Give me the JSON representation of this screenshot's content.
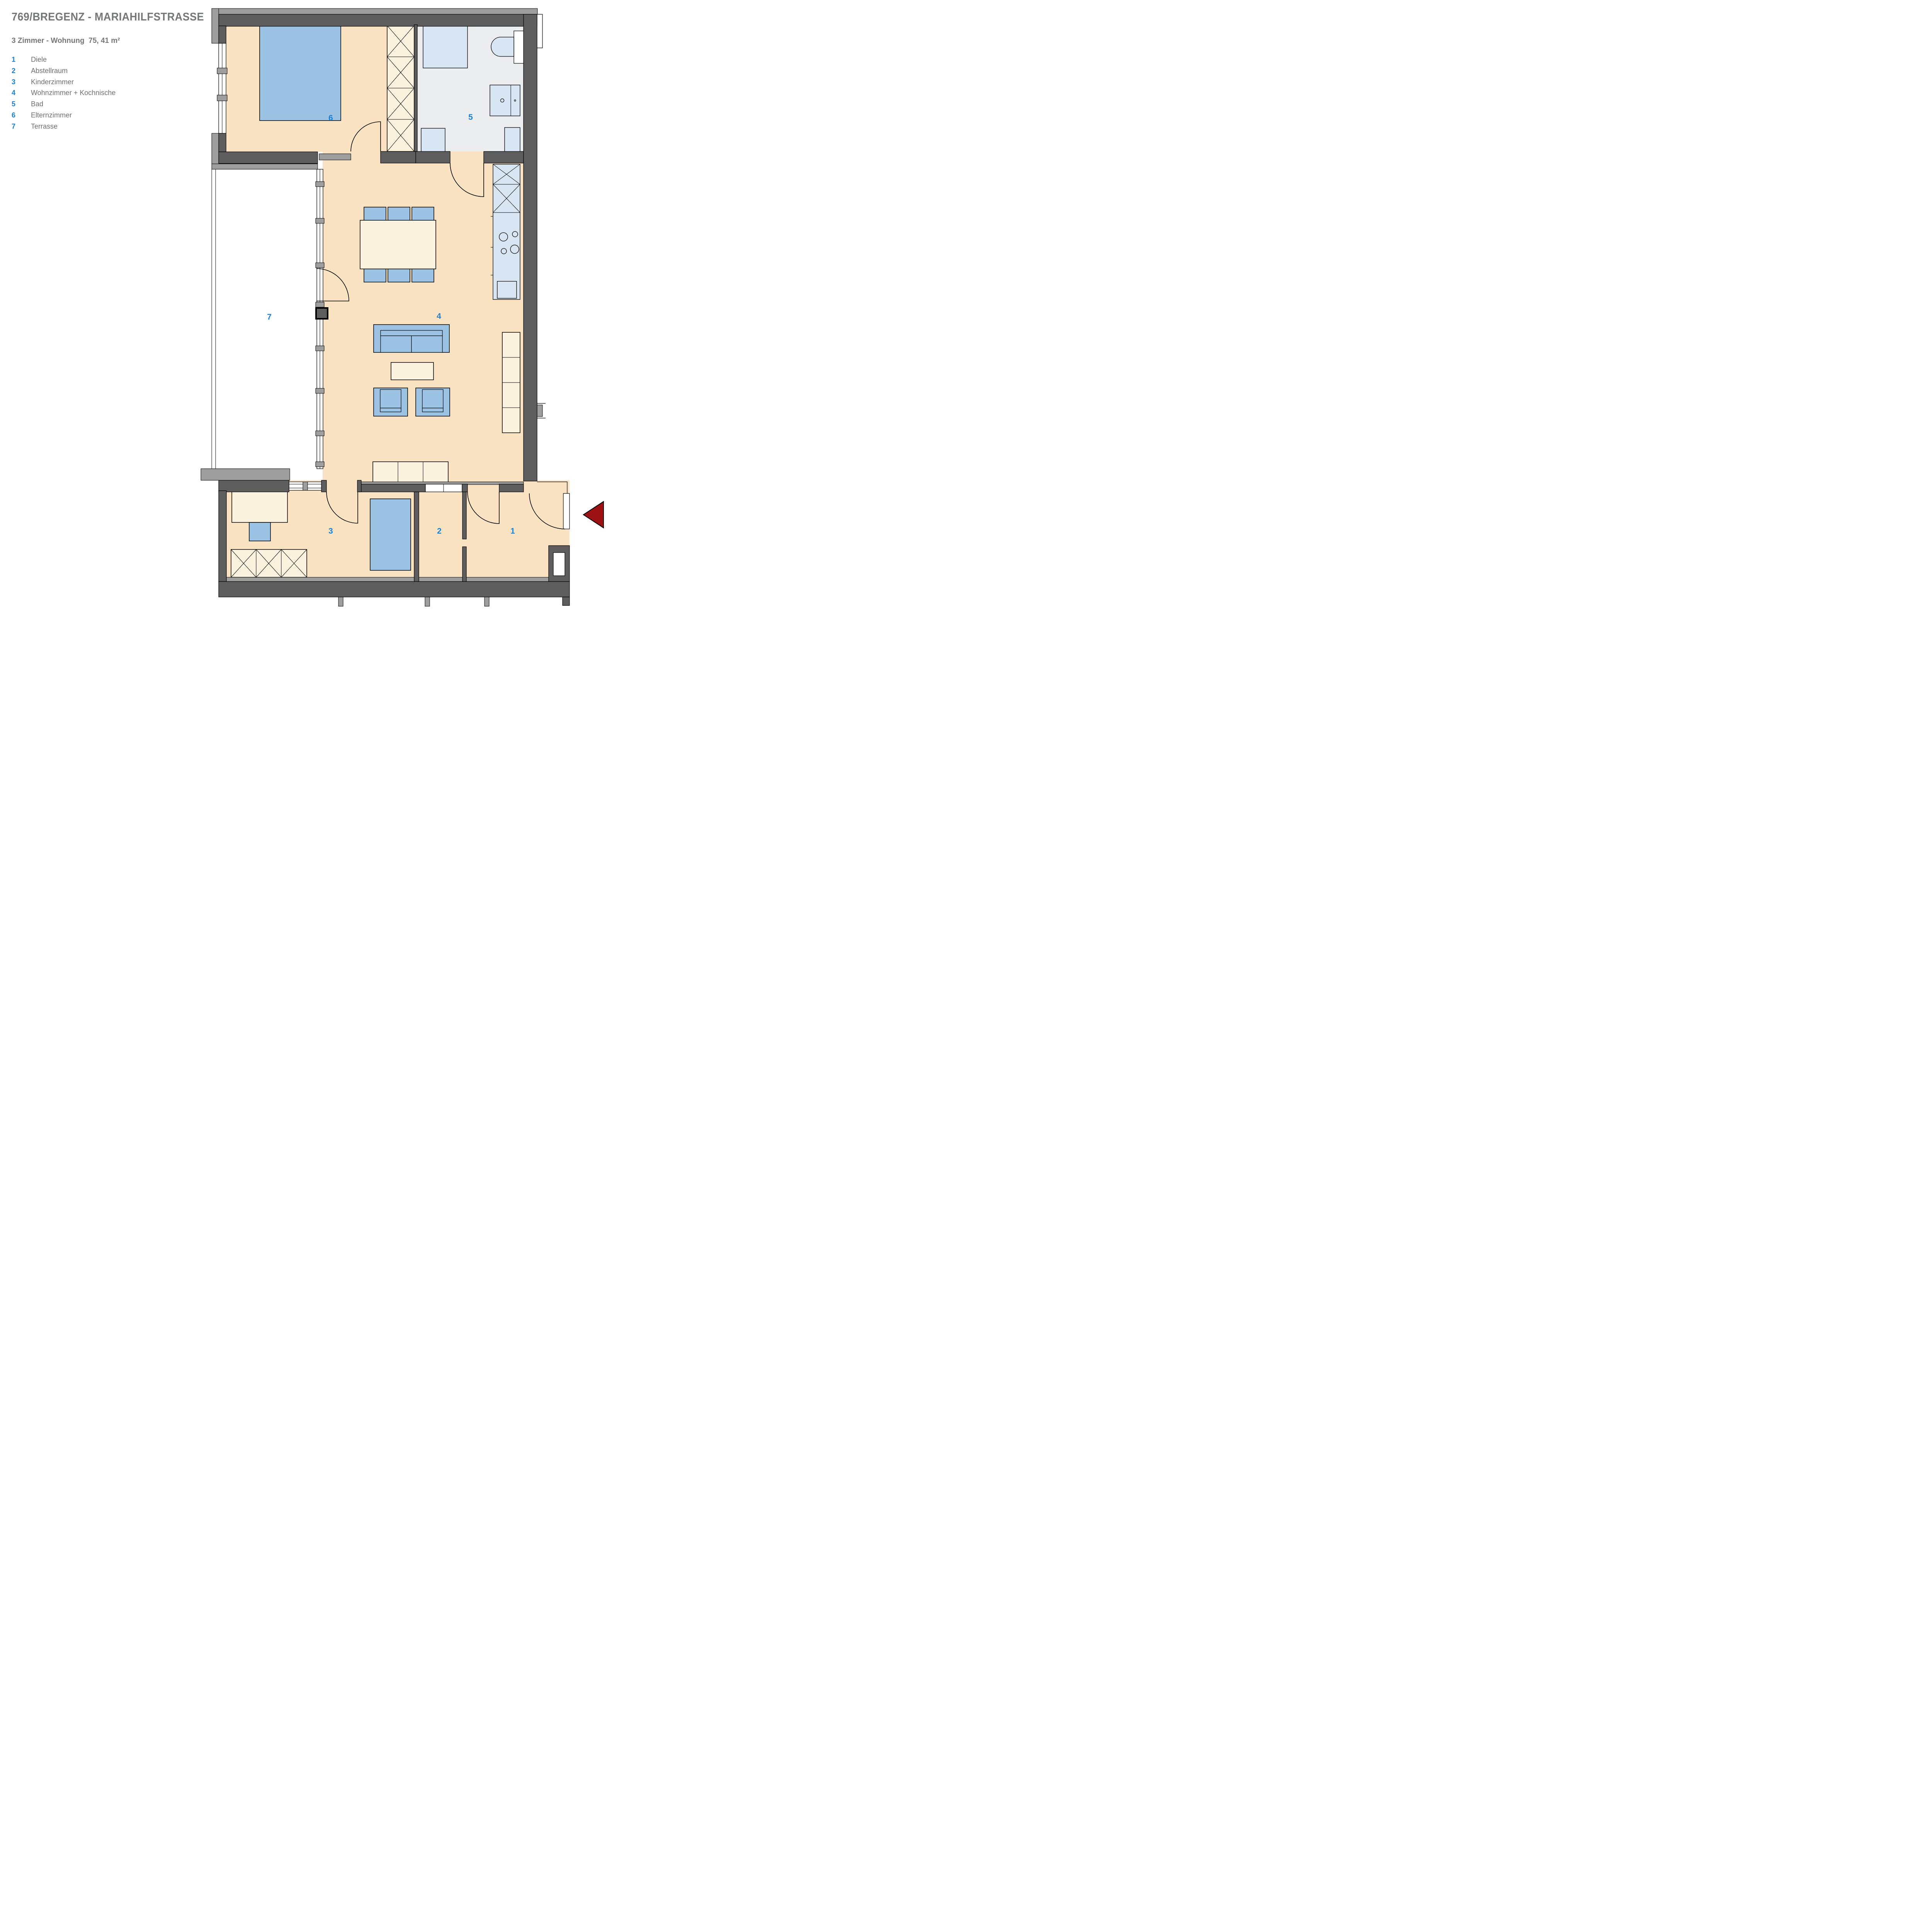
{
  "header": {
    "title": "769/BREGENZ - MARIAHILFSTRASSE",
    "subtitle": "3 Zimmer - Wohnung  75, 41 m²"
  },
  "legend": {
    "items": [
      {
        "number": "1",
        "label": "Diele"
      },
      {
        "number": "2",
        "label": "Abstellraum"
      },
      {
        "number": "3",
        "label": "Kinderzimmer"
      },
      {
        "number": "4",
        "label": "Wohnzimmer + Kochnische"
      },
      {
        "number": "5",
        "label": "Bad"
      },
      {
        "number": "6",
        "label": "Elternzimmer"
      },
      {
        "number": "7",
        "label": "Terrasse"
      }
    ]
  },
  "plan": {
    "type": "apartment-floor-plan",
    "rooms_total": 7,
    "entrance": {
      "symbol": "red-arrow-left",
      "location": "right wall of room 1 (Diele)"
    }
  },
  "colors": {
    "room_floor": "#fae3c2",
    "bath_floor": "#ebedee",
    "furniture_blue": "#9cc3e3",
    "furniture_cream": "#fcf3de",
    "fixture_light_blue": "#d8e6f3",
    "wall_dark": "#5e5e5e",
    "wall_light": "#9e9e9e",
    "label_blue": "#1c80d4",
    "text_gray": "#76777a",
    "entrance_red": "#9c1212"
  }
}
